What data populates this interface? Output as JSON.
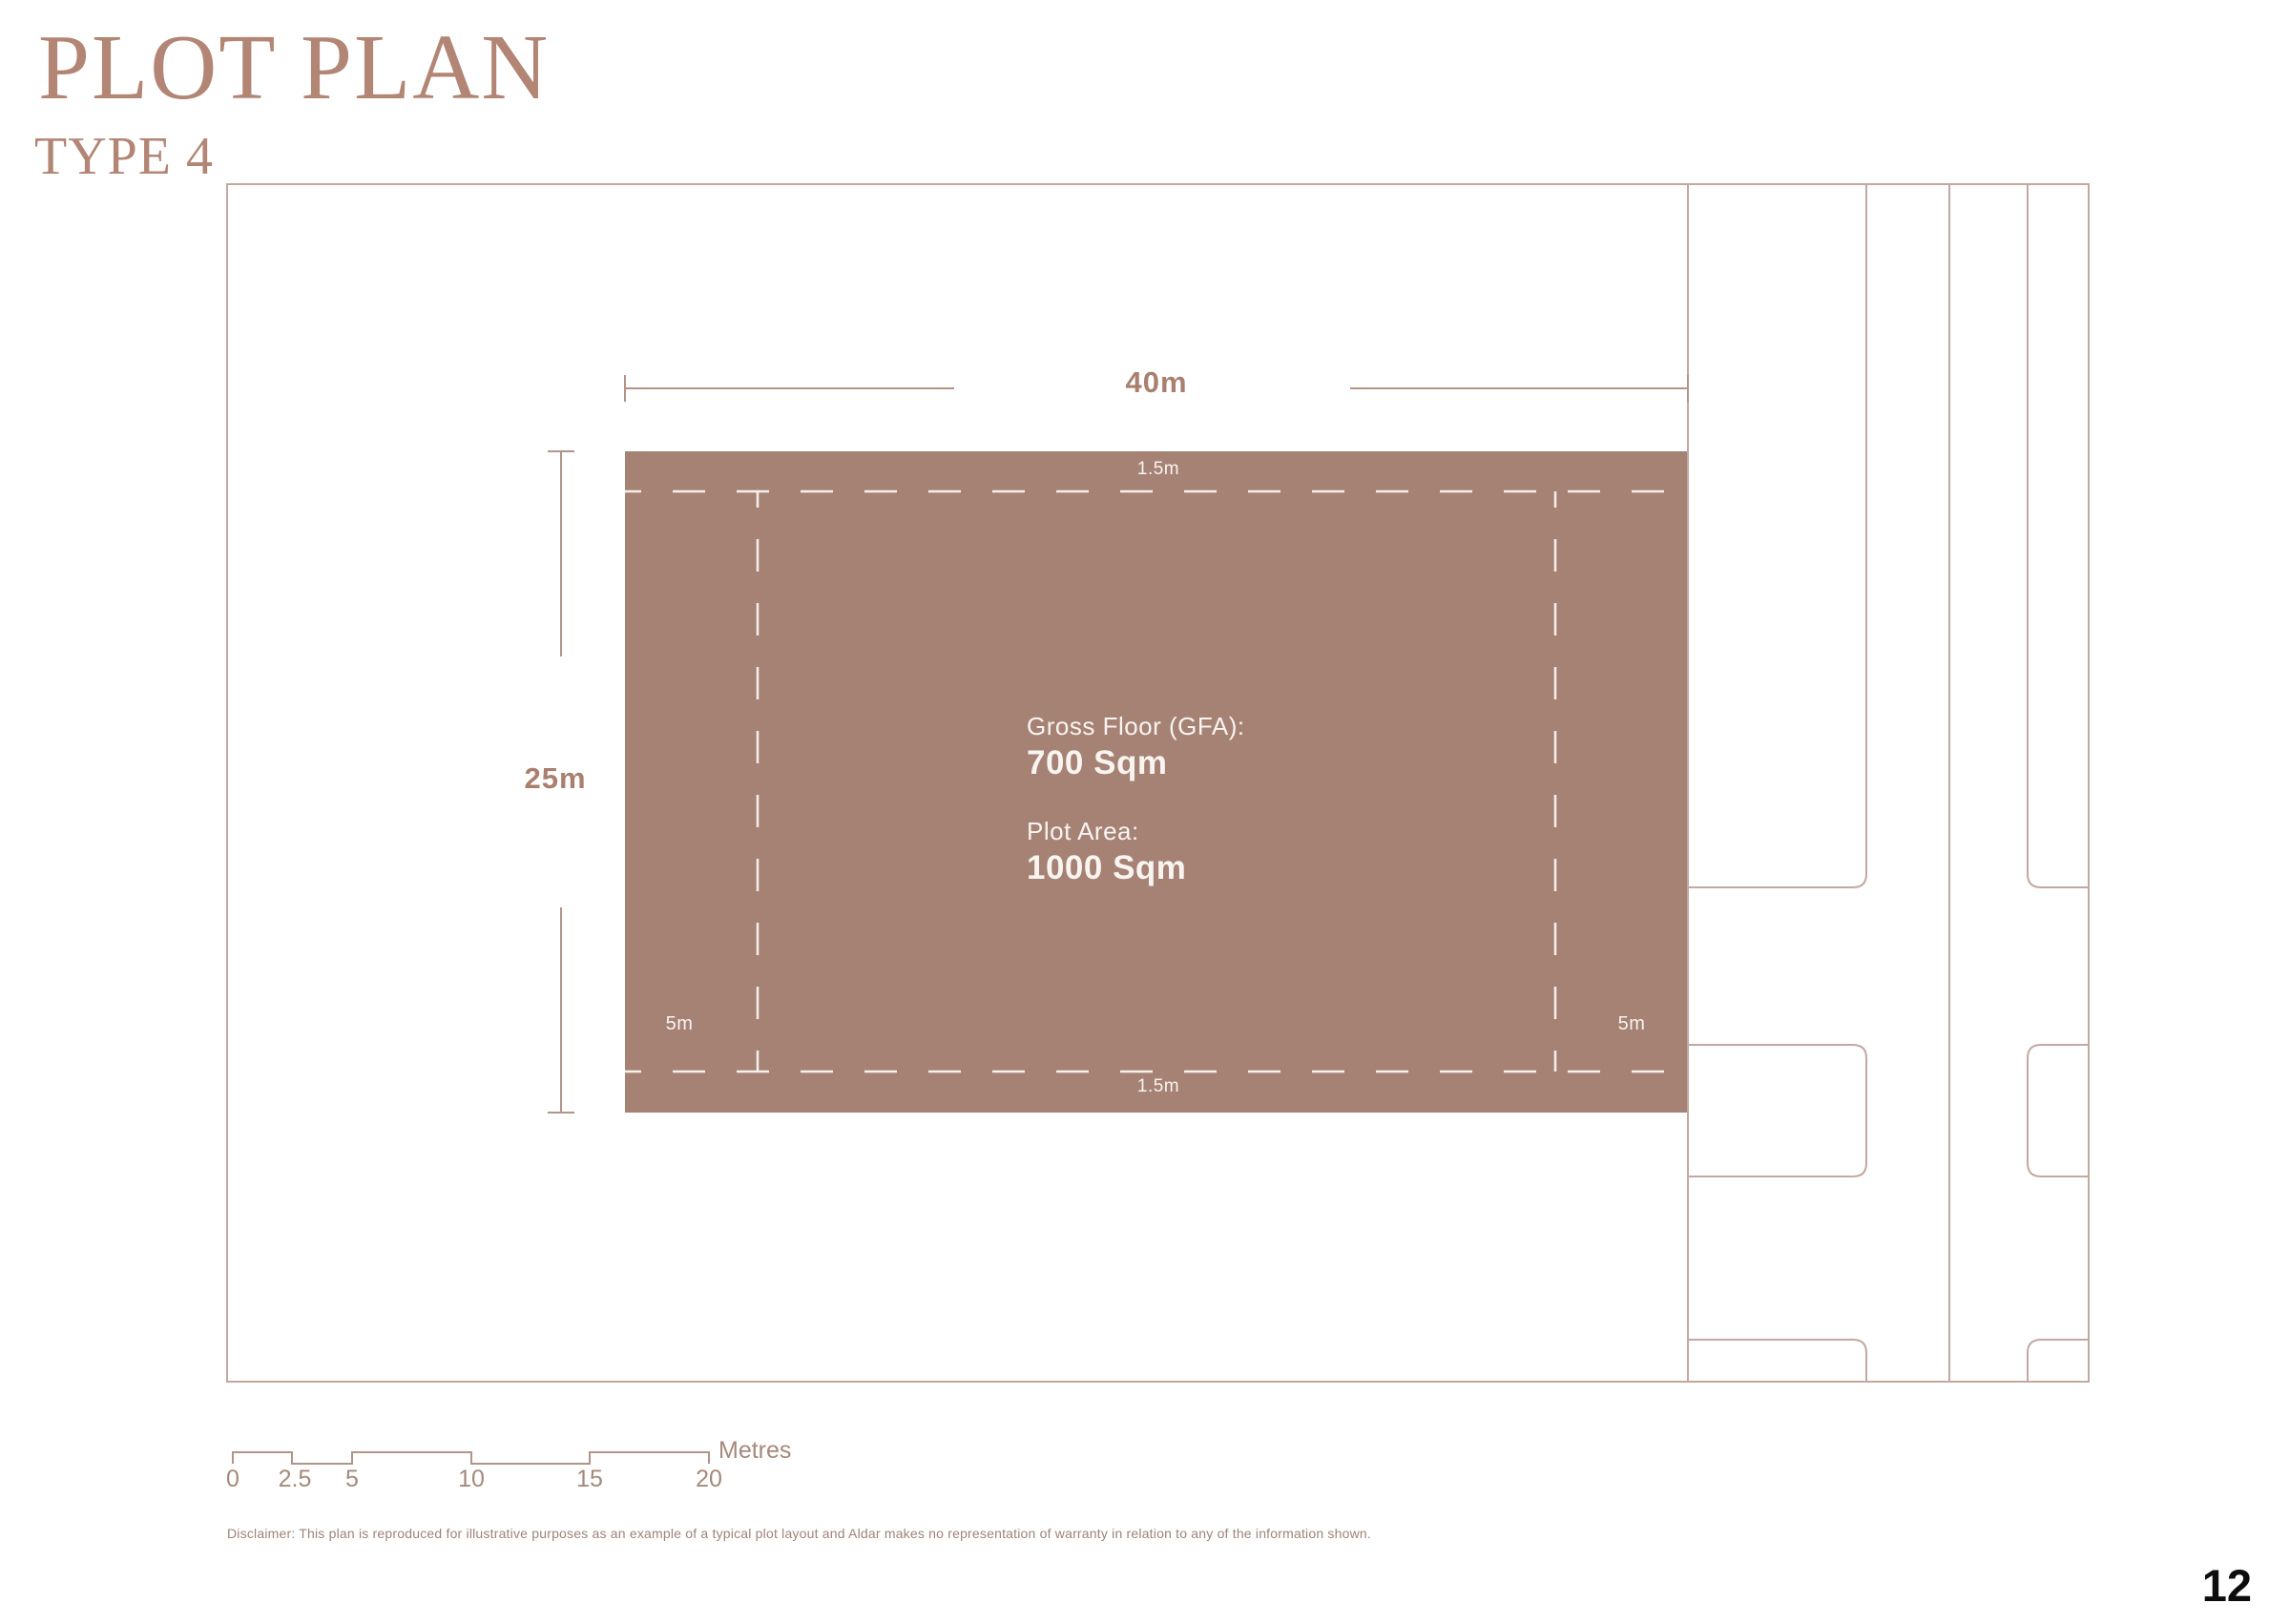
{
  "page": {
    "title": "PLOT PLAN",
    "subtitle": "TYPE 4",
    "page_number": "12",
    "disclaimer": "Disclaimer: This plan is reproduced for illustrative purposes as an example of a typical plot layout and Aldar makes no representation of warranty in relation to any of the information shown."
  },
  "parcel": {
    "width_dimension": "40m",
    "depth_dimension": "25m",
    "setback_top": "1.5m",
    "setback_bottom": "1.5m",
    "setback_left": "5m",
    "setback_right": "5m",
    "gfa_label": "Gross Floor (GFA):",
    "gfa_value": "700 Sqm",
    "plot_area_label": "Plot Area:",
    "plot_area_value": "1000 Sqm"
  },
  "scale_bar": {
    "unit": "Metres",
    "ticks": [
      "0",
      "2.5",
      "5",
      "10",
      "15",
      "20"
    ]
  },
  "colors": {
    "accent_brown": "#b28575",
    "parcel_fill": "#a68275",
    "plan_line": "#c1a9a1",
    "dimension_line": "#b2948a",
    "dimension_text": "#a9806f",
    "setback_dash": "#f6f0ea",
    "page_number_text": "#0d0d0d"
  }
}
